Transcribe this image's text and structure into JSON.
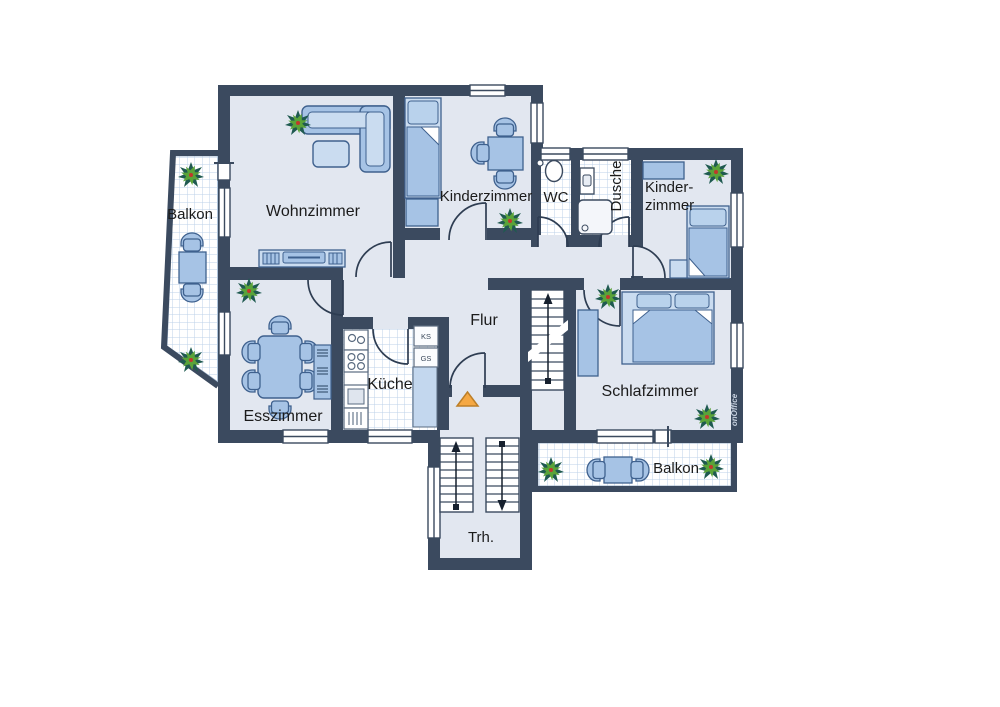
{
  "rooms": {
    "balkon_left": "Balkon",
    "wohnzimmer": "Wohnzimmer",
    "kinderzimmer_top": "Kinderzimmer",
    "wc": "WC",
    "dusche": "Dusche",
    "kinderzimmer_right_line1": "Kinder-",
    "kinderzimmer_right_line2": "zimmer",
    "flur": "Flur",
    "kueche": "Küche",
    "esszimmer": "Esszimmer",
    "schlafzimmer": "Schlafzimmer",
    "balkon_right": "Balkon",
    "treppenhaus": "Trh."
  },
  "kitchen_appliances": {
    "fridge_abbr": "KS",
    "dishwasher_abbr": "GS"
  },
  "watermark": "onOffice",
  "icons": {
    "plant": "plant-icon",
    "entrance_marker": "entrance-arrow-icon",
    "stairs_up": "stairs-up-arrow-icon",
    "stairs_down": "stairs-down-arrow-icon"
  },
  "colors": {
    "wall": "#3b4a5f",
    "room_fill": "#e2e7f0",
    "furniture": "#a6c3e5",
    "furniture_light": "#cadcf0",
    "furniture_stroke": "#3f618e",
    "tile_line": "#bcd2e8",
    "entrance_orange": "#f5a843",
    "plant_green": "#5aa339",
    "plant_dark": "#1f5a50"
  }
}
